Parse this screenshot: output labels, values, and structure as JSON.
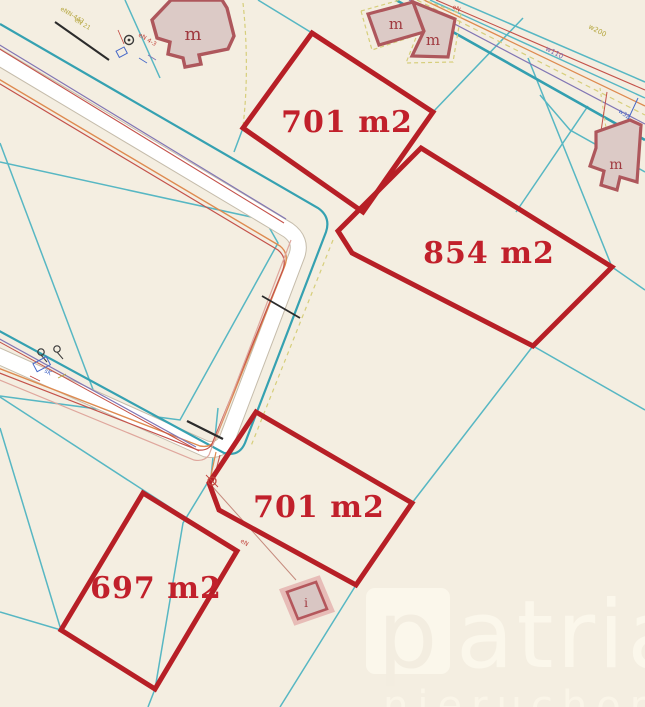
{
  "map": {
    "type": "cadastral-parcel-map",
    "colors": {
      "background": "#f4eee1",
      "boundary_cyan": "#57b7c3",
      "road_teal": "#339fb0",
      "parcel_highlight": "#b71f26",
      "parcel_label": "#c1202b",
      "building_fill": "#dccac6",
      "building_stroke": "#ae575c",
      "road_surface": "#ffffff",
      "utility_orange": "#de8a50",
      "utility_red": "#c4524a",
      "utility_purple": "#8276b4",
      "utility_pink": "#dfa79d",
      "utility_yellow": "#d6ce7b",
      "utility_blue": "#4668c8"
    },
    "parcels": [
      {
        "area": "701 m2"
      },
      {
        "area": "854 m2"
      },
      {
        "area": "701 m2"
      },
      {
        "area": "697 m2"
      }
    ],
    "buildings": [
      {
        "label": "m"
      },
      {
        "label": "m"
      },
      {
        "label": "m"
      },
      {
        "label": "m"
      },
      {
        "label": "i"
      }
    ],
    "utility_labels": {
      "water_main": "w110",
      "water_trunk": "w200",
      "water_service": "w32",
      "power_top_right": "eN",
      "power_cluster": "eN 4-3",
      "power_yellow_1": "eNN-443",
      "power_yellow_2": "eN 21",
      "sewer": "sK",
      "service_line": "eN"
    },
    "watermark": {
      "title": "patria",
      "title_initial": "p",
      "subtitle": "nieruchomości"
    }
  }
}
